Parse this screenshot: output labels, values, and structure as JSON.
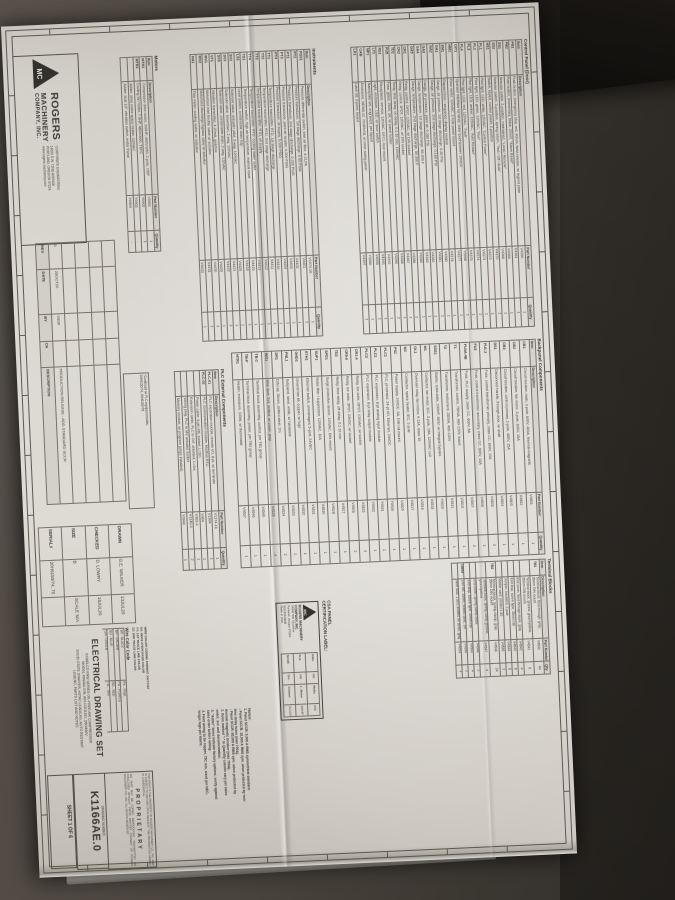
{
  "colors": {
    "paper": "#d8d5cf",
    "carpet": "#45413a",
    "ink": "#3b3934",
    "dark_object": "#1b1915"
  },
  "sheet": {
    "sections": {
      "control_panel": {
        "title": "Control Panel (Door)",
        "columns": [
          "Item",
          "Description",
          "Part Number",
          "Quantity"
        ],
        "rows": [
          [
            "PB1",
            "Push button, emergency stop, red, 40mm, twist-release, w/ legend plate",
            "V4360",
            "1"
          ],
          [
            "PB2",
            "Push button, momentary, black, 22mm, \"Alarm Reset\"",
            "V4361",
            "1"
          ],
          [
            "SS1",
            "Selector switch, 2-position, maintained, \"Local / Remote\"",
            "V4365",
            "1"
          ],
          [
            "SS2",
            "Selector switch, 3-position, spring return, \"Test / Off / Auto\"",
            "V4366",
            "1"
          ],
          [
            "HS1",
            "Switch, keyed, control power, 2-position",
            "V4370",
            "1"
          ],
          [
            "PL1",
            "Pilot light, LED, white, 120VAC, \"Control Power\"",
            "V4372",
            "1"
          ],
          [
            "PL2",
            "Pilot light, LED, green, 120VAC, \"Run\"",
            "V4373",
            "1"
          ],
          [
            "PL3",
            "Pilot light, LED, amber, 120VAC, \"Auto Restart\"",
            "V4374",
            "1"
          ],
          [
            "PL4",
            "Pilot light, LED, red, 120VAC, \"Fault\"",
            "V4375",
            "1"
          ],
          [
            "OIT1",
            "Operator interface terminal, color touchscreen, 24VDC",
            "Y0958",
            "1"
          ],
          [
            "HM1",
            "Hour meter, 120VAC, 2-hole panel mount",
            "V4377",
            "1"
          ],
          [
            "EM1",
            "Elapsed time / sequence display module",
            "V4378",
            "1"
          ],
          [
            "GA1",
            "Gauge, air pressure, 1st stage discharge, 0-30 PSI",
            "V4380",
            "1"
          ],
          [
            "GA2",
            "Gauge, air pressure, 2nd stage discharge, 0-160 PSI",
            "V4381",
            "1"
          ],
          [
            "GA3",
            "Gauge, air pressure, plant air, 0-160 PSI",
            "V4382",
            "1"
          ],
          [
            "GA4",
            "Gauge, temperature, 1st stage discharge, 50-300 F",
            "V4383",
            "1"
          ],
          [
            "GA5",
            "Gauge, temperature, 2nd stage discharge, 50-300 F",
            "V4384",
            "1"
          ],
          [
            "CR1",
            "Relay, control, DPDT, 120VAC, w/ DIN socket",
            "V4386",
            "2"
          ],
          [
            "CR2",
            "Relay, control, 3PDT, 120VAC, w/ DIN socket",
            "V4387",
            "1"
          ],
          [
            "TD1",
            "Relay, time delay, on-delay, 0.1-10 min, 120VAC",
            "V4388",
            "1"
          ],
          [
            "FU5",
            "Fuse, glass, 250V, 3A, w/ panel holder",
            "V4390",
            "2"
          ],
          [
            "RS1",
            "Receptacle, service, 120VAC, GFCI, door mount",
            "V4392",
            "1"
          ],
          [
            "LT1",
            "Light, enclosure, LED, w/ door switch",
            "V4393",
            "1"
          ],
          [
            "NP1",
            "Nameplate set, engraved, per layout",
            "V4395",
            "1"
          ],
          [
            "CAB",
            "Enclosure, NEMA 12, 72x60x18, w/ inner swing panel",
            "Y0950",
            "1"
          ],
          [
            "LK1",
            "Latch kit, 3-point, keyed",
            "V4397",
            "1"
          ]
        ]
      },
      "instruments": {
        "title": "Instruments",
        "columns": [
          "Item",
          "Description",
          "Part Number",
          "Quantity"
        ],
        "rows": [
          [
            "PDS1",
            "Pressure differential switch, inlet air filter, 4-CLPA",
            "V1374-16",
            "1"
          ],
          [
            "PT1",
            "Pressure transducer, 1st stage discharge, 0-50 PSIA",
            "V4401",
            "1"
          ],
          [
            "PT2",
            "Pressure transducer, 2nd stage discharge, 0-200 PSIG",
            "V4402",
            "1"
          ],
          [
            "PT3",
            "Pressure transducer, plant air header, 0-200 PSIG",
            "V4403",
            "1"
          ],
          [
            "PT4",
            "Pressure transducer, oil supply, 0-100 PSIG",
            "V4404",
            "1"
          ],
          [
            "TT1",
            "Temperature transmitter, RTD, 1st stage discharge",
            "V4410",
            "1"
          ],
          [
            "TT2",
            "Temperature transmitter, RTD, 2nd stage discharge",
            "V4411",
            "1"
          ],
          [
            "TT3",
            "Temperature transmitter, RTD, oil supply",
            "V4412",
            "1"
          ],
          [
            "TT4",
            "Temperature transmitter, RTD, cooling water outlet",
            "V4413",
            "1"
          ],
          [
            "TS1",
            "Temperature switch, high air temperature, manual reset",
            "V4415",
            "1"
          ],
          [
            "LS1",
            "Level switch, condensate drain trap",
            "V4416",
            "1"
          ],
          [
            "SV1",
            "Solenoid valve, unloader pilot, 3-way, 120VAC",
            "V4420",
            "1"
          ],
          [
            "SV2",
            "Solenoid valve, blowdown, 2-way, 120VAC",
            "V4421",
            "1"
          ],
          [
            "SV3",
            "Solenoid valve, condensate drain, 2-way, 120VAC",
            "V4422",
            "2"
          ],
          [
            "VT1",
            "Vibration transmitter, 4-20mA, gearbox",
            "V4425",
            "1"
          ],
          [
            "MV1",
            "Motorized inlet throttle valve w/ actuator",
            "V4430",
            "1"
          ],
          [
            "MV2",
            "Motorized discharge bypass valve w/ actuator",
            "V4431",
            "1"
          ],
          [
            "FM1",
            "Flow meter, cooling water, w/ indicator",
            "V4433",
            "1"
          ]
        ]
      },
      "motors": {
        "title": "Motors",
        "columns": [
          "Item",
          "Description",
          "Part Number",
          "Quantity"
        ],
        "rows": [
          [
            "MTR1",
            "Compressor drive motor, 200HP, 460V/3/60, 2-pole, ODP",
            "Y0901",
            "1"
          ],
          [
            "MTR2",
            "Cooling fan motor, 7.5HP, 460V/3/60, TEFC",
            "Y0902",
            "1"
          ],
          [
            "",
            "Adder: drive motor space heater, 120VAC",
            "Y0903",
            "-"
          ],
          [
            "",
            "Adder: dual 1/2\" vibration switch, motor frame",
            "Y0904",
            "-"
          ]
        ]
      },
      "backpanel": {
        "title": "Backpanel Components",
        "columns": [
          "Item",
          "Description",
          "Part Number",
          "Quantity"
        ],
        "rows": [
          [
            "CB1",
            "Circuit breaker, main, 3-pole, 600V, 400A, thermal-magnetic",
            "V4501",
            "1"
          ],
          [
            "CB2",
            "Circuit breaker, fan motor, 3-pole, 600V, 15A",
            "V4502",
            "1"
          ],
          [
            "CB3",
            "Circuit breaker, control primary, 2-pole, 480V, 15A",
            "V4503",
            "1"
          ],
          [
            "DS1",
            "Disconnect handle, through-door, w/ shaft",
            "V4504",
            "1"
          ],
          [
            "FU1-2",
            "Fuse, control transformer primary, class CC, 600V, 10A",
            "V4505",
            "2"
          ],
          [
            "FU3",
            "Fuse, control transformer secondary, class CC, 600V, 15A",
            "V4506",
            "1"
          ],
          [
            "FU4A-4B",
            "Fuse, PLC supply, class CC, 600V, 5A",
            "V4507",
            "2"
          ],
          [
            "T1",
            "Transformer, control, 750VA, 460-120V, fused",
            "V4510",
            "1"
          ],
          [
            "T2",
            "Transformer, instrument, 250VA, 460-120V",
            "V4511",
            "1"
          ],
          [
            "SSS1",
            "Starter, solid-state, 200HP, 460V, w/ integral bypass",
            "Y0920",
            "1"
          ],
          [
            "M1",
            "Contactor, fan motor, IEC, 3-pole, 18A, 120VAC coil",
            "V4515",
            "1"
          ],
          [
            "OL1",
            "Overload relay, fan motor, 9-13A, class 10",
            "V4516",
            "1"
          ],
          [
            "M2",
            "Contactor, space heater, IEC, 2-pole",
            "V4517",
            "1"
          ],
          [
            "PS1",
            "Power supply, 24VDC, 5A, DIN rail mount",
            "V4520",
            "1"
          ],
          [
            "PLC1",
            "PLC, processor, 24-pt I/O, Ethernet, 24VDC",
            "Y0930",
            "1"
          ],
          [
            "PLC2",
            "PLC expansion, 8-pt analog input module",
            "Y0931",
            "1"
          ],
          [
            "PLC3",
            "PLC expansion, 8-pt relay output module",
            "Y0932",
            "1"
          ],
          [
            "CR1-4",
            "Relay, ice cube, DPDT, 120VAC, w/ socket",
            "V4525",
            "4"
          ],
          [
            "CR5-6",
            "Relay, ice cube, 3PDT, 24VDC, w/ socket",
            "V4526",
            "2"
          ],
          [
            "TD2",
            "Relay, time delay, off-delay, 0.1-10 min",
            "V4527",
            "1"
          ],
          [
            "SPD1",
            "Surge protective device, 120VAC, DIN mount",
            "V4528",
            "1"
          ],
          [
            "SUP1",
            "Noise filter / suppressor, 120VAC, 10A",
            "V4530",
            "1"
          ],
          [
            "ETH1",
            "Ethernet switch, unmanaged, 5-port, 24VDC",
            "V4531",
            "1"
          ],
          [
            "GND1",
            "Ground bar kit, copper, w/ lugs",
            "V4532",
            "1"
          ],
          [
            "PNL1",
            "Subpanel, steel, white, w/ hardware",
            "V4533",
            "1"
          ],
          [
            "DR1",
            "DIN rail, 35mm, slotted steel, 2m",
            "V4534",
            "2"
          ],
          [
            "WD1",
            "Wire duct, 2x3, slotted, w/ cover, gray",
            "V4535",
            "4"
          ],
          [
            "TB-C",
            "Terminal block assembly, control, per TB1 group",
            "V4540",
            "1"
          ],
          [
            "TB-P",
            "Terminal block assembly, power, per TB2 group",
            "V4546",
            "1"
          ],
          [
            "HTR1",
            "Heater, enclosure, 100W, w/ thermostat",
            "V4537",
            "1"
          ]
        ]
      },
      "plc_external": {
        "title": "PLC External Components",
        "columns": [
          "Item",
          "Description",
          "Part Number",
          "Quantity"
        ],
        "rows": [
          [
            "PLC-01",
            "PLC expansion module, remote I/O, 8-pt, w/ terminals",
            "V1374-16",
            "1"
          ],
          [
            "PLC-02",
            "PLC communication module, Modbus RTU",
            "V1304",
            "1"
          ],
          [
            "",
            "Power cable, 6-pin MIL socket, L=2m",
            "V404",
            "1"
          ],
          [
            "",
            "Extension cable, PLC to OIT, shielded, L=3m",
            "V369-4",
            "1"
          ],
          [
            "",
            "Wiring plug, PLC to MV actuator socket",
            "V1340-4",
            "2"
          ],
          [
            "",
            "Memory module, w/ program (ships installed)",
            "Y0940",
            "1"
          ]
        ]
      },
      "terminal_blocks": {
        "title": "Terminal Blocks",
        "columns": [
          "Item",
          "Description",
          "Part Number",
          "Qty"
        ],
        "rows": [
          [
            "TB1",
            "Terminal block, feed-through, gray, 35mm DIN mount",
            "V4540",
            "44"
          ],
          [
            "",
            "Terminal block, ground, green/yellow, 35mm DIN mount",
            "V4541",
            "6"
          ],
          [
            "",
            "End cover, feed-through block, gray",
            "V4542",
            "4"
          ],
          [
            "",
            "End stop, screw type, 35mm rail",
            "V4543",
            "8"
          ],
          [
            "",
            "Jumper, insulated, 2-pole",
            "V4544",
            "6"
          ],
          [
            "",
            "Marker card, printed 1-50",
            "V4545",
            "2"
          ],
          [
            "TB2",
            "Terminal block, spring clamp, gray, 35mm DIN mount",
            "V4546",
            "24"
          ],
          [
            "",
            "Terminal block, spring clamp ground, green/yellow",
            "V4547",
            "4"
          ],
          [
            "",
            "End cover, spring clamp block",
            "V4548",
            "2"
          ],
          [
            "",
            "End stop, screw type, 35mm rail",
            "V4543",
            "4"
          ],
          [
            "Other",
            "DIN rail, 35mm, slotted steel, 1m",
            "V4550",
            "2"
          ],
          [
            "",
            "Wire duct, 1.5x3, slotted, w/ cover, gray",
            "V4551",
            "3"
          ]
        ]
      }
    },
    "continued_note": {
      "line1": "*Continued w/ PLC-equipped builds:",
      "line2": "20H6150/74, 20H6150/75"
    },
    "csa": {
      "heading_lines": [
        "CSA PANEL",
        "CERTIFICATION LABEL:"
      ],
      "monogram": "MC",
      "label_lines": [
        "ROGERS MACHINERY COMPANY, INC.",
        "14600 SW 72nd Ave",
        "Portland, Oregon 97224",
        "503-639-0808",
        "Made in USA"
      ],
      "fields": [
        [
          "Volts",
          "460",
          "Ph/Hz",
          "3/60"
        ],
        [
          "FLA",
          "248",
          "L. Motor",
          "200HP"
        ],
        [
          "SCCR",
          "5kA",
          "Control",
          "AC120V 15A"
        ]
      ]
    },
    "notes": {
      "lines": [
        "Notes:",
        "1. Panel SCCR: 5,000 A RMS symmetrical standard.",
        "- Panel SCCR: 18,000 A RMS sym. when protected by non-time delay fuses (max 700A).",
        "- Panel SCCR: 65,000 A RMS sym. when protected by thermal magnetic breaker (max 700A).",
        "2. Items marked \"-\" in Quantity column vary per sales order; see unit documentation.",
        "3. \"Adder\" items indicate factory options; verify against sales order before wiring.",
        "4. Field wiring to be copper, 75C min, sized per NEC; torque lugs per labels."
      ]
    },
    "wire_color_code": {
      "format_lines": [
        "WIRE COLOR CODING FORMAT: XX/YY/ZZ",
        "XX: INSULATION BASE COLOR",
        "YY: 1ST TRACE LINE COLOR",
        "ZZ: 2ND TRACE LINE COLOR"
      ],
      "title": "Wire Color Code",
      "rows": [
        [
          "BK - BLACK",
          "PK - PINK"
        ],
        [
          "BR - BROWN",
          "PU - PURPLE"
        ],
        [
          "BU - BLUE",
          "RD - RED"
        ],
        [
          "GN - GREEN",
          "TN - TAN"
        ],
        [
          "GY - GRAY",
          "WH - WHITE"
        ],
        [
          "OR - ORANGE",
          "YL - YELLOW"
        ]
      ]
    },
    "logo": {
      "monogram": "MC",
      "name_lines": [
        "ROGERS",
        "MACHINERY",
        "COMPANY, INC."
      ],
      "addr_lines": [
        "CORPORATE ENGINEERING",
        "14600 S.W. 72ND AVENUE",
        "PORTLAND, OREGON 97224",
        "www.rogers-machinery.com"
      ]
    },
    "rev_table": {
      "headers": [
        "REV",
        "DATE",
        "BY",
        "CK",
        "DESCRIPTION"
      ],
      "rows": [
        [
          "",
          "",
          "",
          "",
          ""
        ],
        [
          "",
          "",
          "",
          "",
          ""
        ],
        [
          "",
          "",
          "",
          "",
          ""
        ],
        [
          "",
          "",
          "",
          "",
          ""
        ],
        [
          "0",
          "26OCT20",
          "GEW",
          "",
          "PRODUCTION RELEASE - ADD STANDARD SCCR"
        ]
      ]
    },
    "drawn_block": {
      "rows": [
        [
          "DRAWN",
          "G.E. WILKER",
          "13JUL20"
        ],
        [
          "CHECKED",
          "D. LOWRY",
          "16JUL20"
        ],
        [
          "SIZE",
          "B",
          "SCALE  N/A"
        ],
        [
          "SERIAL#",
          "20H6150/74, 75",
          ""
        ]
      ]
    },
    "title_block": {
      "title": "ELECTRICAL DRAWING SET",
      "subtitle_lines": [
        "KOBELCO KNW SERIES OIL-FREE AIR COMPRESSOR",
        "MODEL KNWA0-G/H, AIR-COOLED, 3/60/460V",
        "SOLID-STATE STARTER, eSTAC LEAD/LAG, AUTO RESTART",
        "LEGEND, PARTS LIST AND NOTES"
      ]
    },
    "proprietary": {
      "heading": "PROPRIETARY",
      "para1": "THIS PRINT IS THE PROPERTY OF ROGERS MACHINERY CO., INC. AND IS SUBJECT TO RETURN UPON REQUEST. THE INFORMATION HEREIN IS CONFIDENTIAL.",
      "para2": "NO PART MAY BE COPIED, REPRODUCED, TRANSMITTED OR DISCLOSED WITHOUT PRIOR WRITTEN CONSENT OF ROGERS MACHINERY CO., INC. ALL RIGHTS RESERVED."
    },
    "drawing_number": {
      "label": "DRAWING NUMBER",
      "number": "K1166AE.0",
      "sheet": "SHEET 1 OF 6"
    }
  }
}
